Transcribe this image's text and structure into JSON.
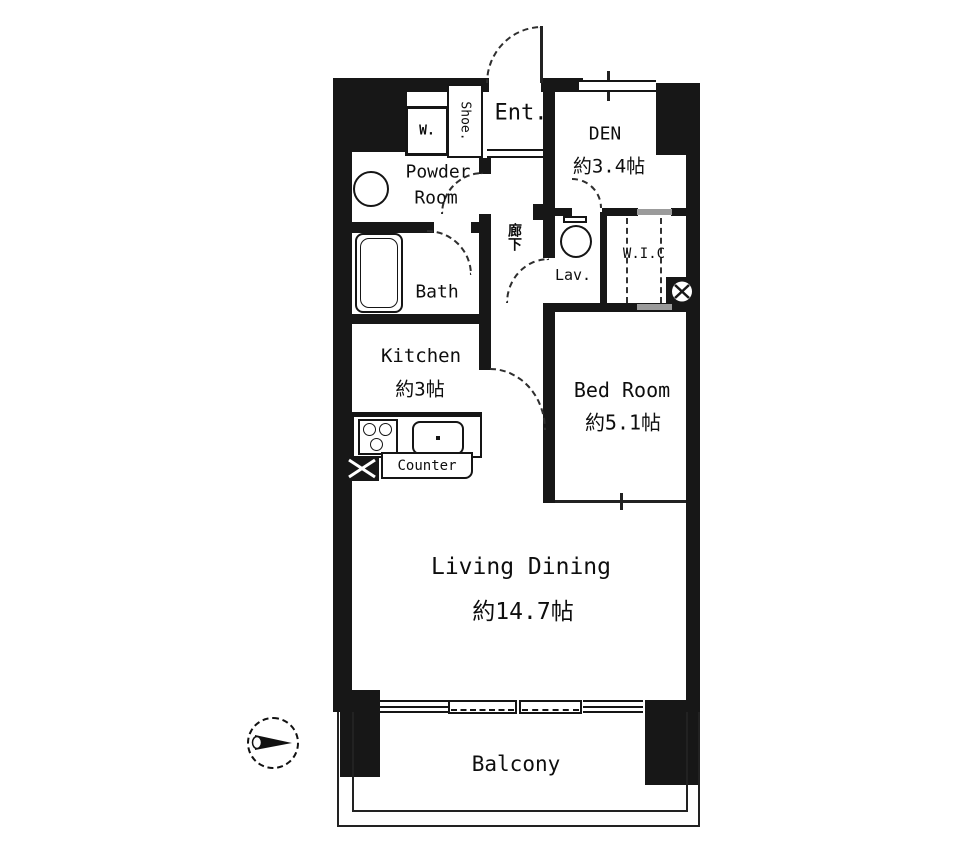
{
  "diagram": {
    "type": "apartment-floor-plan",
    "rooms": {
      "entrance": {
        "label": "Ent."
      },
      "den": {
        "label": "DEN",
        "area": "約3.4帖"
      },
      "shoe_closet": {
        "label": "Shoe."
      },
      "washer": {
        "label": "W."
      },
      "powder_room": {
        "label_line1": "Powder",
        "label_line2": "Room"
      },
      "bath": {
        "label": "Bath"
      },
      "kitchen": {
        "label": "Kitchen",
        "area": "約3帖"
      },
      "corridor": {
        "label": "廊下"
      },
      "lavatory": {
        "label": "Lav."
      },
      "walk_in_closet": {
        "label": "W.I.C"
      },
      "bedroom": {
        "label": "Bed Room",
        "area": "約5.1帖"
      },
      "living_dining": {
        "label": "Living Dining",
        "area": "約14.7帖"
      },
      "counter": {
        "label": "Counter"
      },
      "balcony": {
        "label": "Balcony"
      }
    },
    "colors": {
      "background": "#ffffff",
      "wall": "#171717",
      "line": "#222222",
      "sliding_door_gray": "#9b9b9b"
    },
    "icons": {
      "compass": "north-arrow-pointing-right",
      "toilet": "toilet-bowl-outline",
      "bathtub": "bathtub-outline",
      "stove": "stove-burner-circles",
      "sink": "kitchen-sink-basin",
      "basin": "round-wash-basin",
      "shaft_box": "x-crossed-box",
      "meter": "x-crossed-circle"
    }
  }
}
